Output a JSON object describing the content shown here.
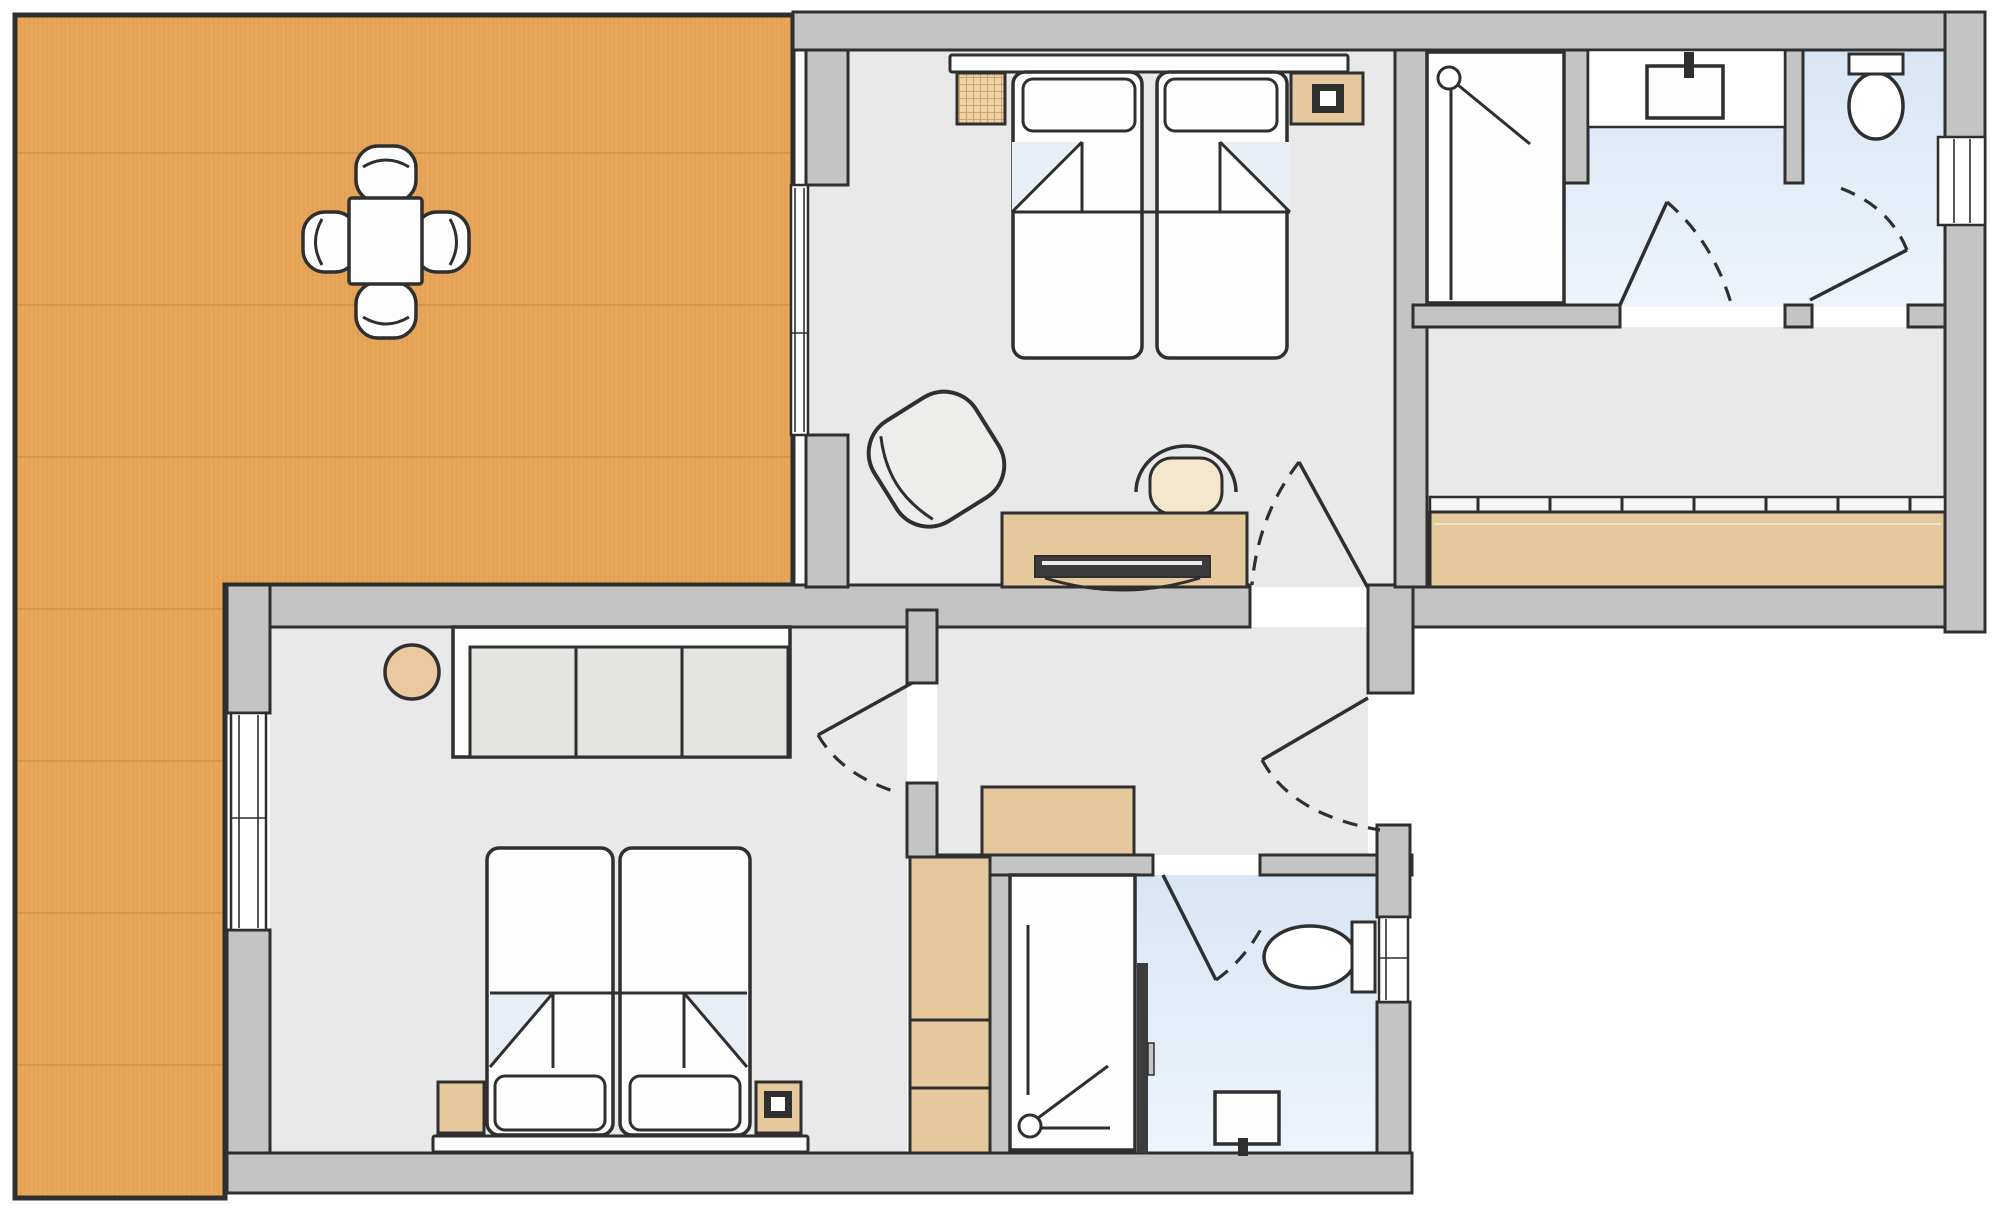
{
  "meta": {
    "type": "floor-plan",
    "name": "apartment-floor-plan",
    "text_labels": []
  },
  "palette": {
    "outline": "#2f2f2f",
    "dark": "#3c3c3c",
    "wall_fill": "#c4c4c4",
    "floor": "#e9e9e9",
    "white": "#fdfdfd",
    "tan": "#e5c99c",
    "fold": "#e8eef5",
    "bath_top": "#d8e6f4",
    "bath_bottom": "#eef4fb",
    "wood": "#e7a65a",
    "wood_grain": "#d89647",
    "wood_seam": "#c88d41",
    "panel": "#e4e4e0",
    "rail": "#f6f6f6",
    "stool": "#eac9a0",
    "seat": "#f5e7cd",
    "armchair": "#ededeb",
    "page_bg": "#ffffff"
  },
  "rooms": [
    {
      "id": "terrace",
      "label": "wood deck terrace (L-shaped, left)",
      "floor": "wood-decking"
    },
    {
      "id": "bedroom-1",
      "label": "bedroom top-center",
      "floor": "light-grey"
    },
    {
      "id": "bathroom-1",
      "label": "bathroom top-right (shower, vanity, toilet)",
      "floor": "blue-tile"
    },
    {
      "id": "corridor",
      "label": "corridor right with built-in wardrobe",
      "floor": "light-grey"
    },
    {
      "id": "hallway",
      "label": "central hallway",
      "floor": "light-grey"
    },
    {
      "id": "bedroom-2",
      "label": "bedroom bottom-left",
      "floor": "light-grey"
    },
    {
      "id": "bathroom-2",
      "label": "bathroom bottom-center (shower, toilet, basin)",
      "floor": "blue-tile"
    }
  ],
  "furniture": {
    "terrace": [
      "dining-table",
      "chair-top",
      "chair-bottom",
      "chair-left",
      "chair-right"
    ],
    "bedroom_1": [
      "double-bed",
      "pillow-left",
      "pillow-right",
      "nightstand-hatched",
      "nightstand-with-lamp",
      "armchair",
      "desk",
      "laptop",
      "desk-chair"
    ],
    "bathroom_1": [
      "shower-cabin",
      "vanity-counter",
      "washbasin",
      "toilet"
    ],
    "corridor": [
      "sliding-door-wardrobe"
    ],
    "hallway": [
      "sideboard"
    ],
    "bedroom_2": [
      "double-bed",
      "pillow-left",
      "pillow-right",
      "nightstand-plain",
      "nightstand-with-lamp",
      "three-door-wardrobe",
      "stool"
    ],
    "bathroom_2": [
      "shower-cabin",
      "toilet",
      "washbasin",
      "tall-cabinet"
    ]
  },
  "windows": [
    "bedroom-1-left-wall",
    "bedroom-2-left-wall",
    "bathroom-2-right-wall",
    "bathroom-1-right-wall"
  ],
  "doors": [
    "bedroom-1-door",
    "bedroom-2-door",
    "bathroom-2-door",
    "hallway-to-corridor-door",
    "bathroom-1-inner-door",
    "bathroom-1-toilet-door"
  ]
}
